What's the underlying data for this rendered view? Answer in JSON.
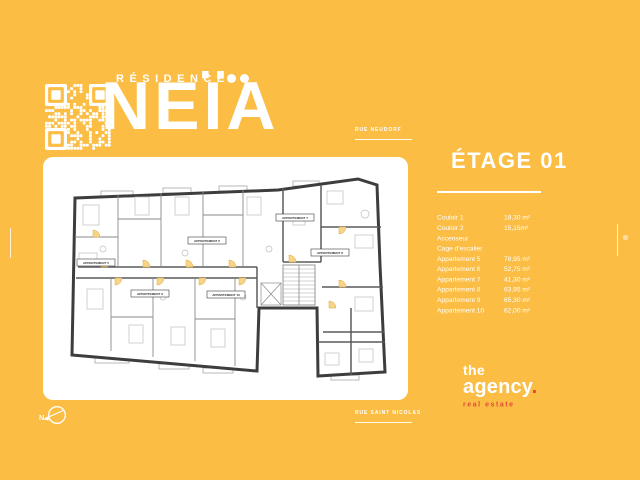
{
  "colors": {
    "background": "#FBBD44",
    "accent": "#E14B33",
    "text": "#FFFFFF"
  },
  "header": {
    "residence_label": "RÉSIDENCE",
    "name": "NEÏA"
  },
  "streets": {
    "top": "RUE NEUDORF",
    "bottom": "RUE SAINT NICOLAS"
  },
  "compass": {
    "north_label": "N"
  },
  "floor": {
    "title": "ÉTAGE 01",
    "rows": [
      {
        "label": "Couloir 1",
        "value": "18,30 m²"
      },
      {
        "label": "Couloir 2",
        "value": "15,15m²"
      },
      {
        "label": "Ascenseur",
        "value": ""
      },
      {
        "label": "Cage d'escalier",
        "value": ""
      },
      {
        "label": "Appartement 5",
        "value": "78,95 m²"
      },
      {
        "label": "Appartement 6",
        "value": "52,75 m²"
      },
      {
        "label": "Appartement 7",
        "value": "41,30 m²"
      },
      {
        "label": "Appartement 8",
        "value": "63,95 m²"
      },
      {
        "label": "Appartement 9",
        "value": "65,30 m²"
      },
      {
        "label": "Appartement 10",
        "value": "62,00 m²"
      }
    ]
  },
  "plan": {
    "units": [
      "APPARTEMENT 5",
      "APPARTEMENT 6",
      "APPARTEMENT 7",
      "APPARTEMENT 8",
      "APPARTEMENT 9",
      "APPARTEMENT 10"
    ]
  },
  "agency": {
    "line1": "the",
    "line2": "agency",
    "dot": ".",
    "tagline": "real estate"
  },
  "icons": {
    "qr": "qr-code",
    "logo_dots": "two-dots",
    "compass": "compass-north-arrow"
  }
}
